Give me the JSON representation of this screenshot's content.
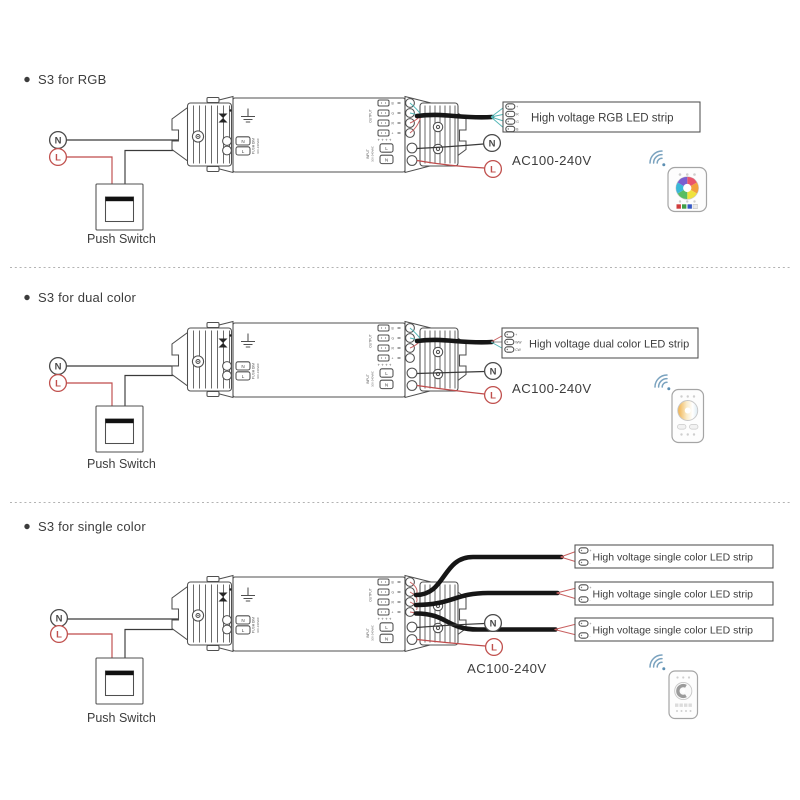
{
  "labels": {
    "n": "N",
    "l": "L"
  },
  "sections": [
    {
      "title": "S3 for RGB",
      "push_switch": "Push Switch",
      "ac": "AC100-240V",
      "strip": {
        "label": "High voltage RGB LED strip",
        "pins": [
          "+",
          "R",
          "G",
          "B"
        ]
      },
      "remote": "rgb-color-wheel-remote"
    },
    {
      "title": "S3 for dual color",
      "push_switch": "Push Switch",
      "ac": "AC100-240V",
      "strip": {
        "label": "High voltage dual color LED strip",
        "pins": [
          "+",
          "WW",
          "CW"
        ]
      },
      "remote": "dual-white-wheel-remote"
    },
    {
      "title": "S3 for single color",
      "push_switch": "Push Switch",
      "ac": "AC100-240V",
      "strips": [
        {
          "label": "High voltage single color LED strip",
          "pins": [
            "+",
            "-"
          ]
        },
        {
          "label": "High voltage single color LED strip",
          "pins": [
            "+",
            "-"
          ]
        },
        {
          "label": "High voltage single color LED strip",
          "pins": [
            "+",
            "-"
          ]
        }
      ],
      "remote": "single-color-dimmer-remote"
    }
  ],
  "controller": {
    "output_label": "OUTPUT",
    "output_pins": [
      "B",
      "G",
      "R",
      "+"
    ],
    "output_plus_row": "+ + + +",
    "push_dim_label": "PUSH DIM",
    "push_dim_pins": [
      "N",
      "L"
    ],
    "input_label": "INPUT",
    "input_voltage": "100-240VAC",
    "input_pins": [
      "L",
      "N"
    ]
  },
  "colors": {
    "outline": "#4f4f4f",
    "live_wire": "#bf4b4b",
    "neutral_wire": "#3a3a3a",
    "signal_wire": "#54b7b7",
    "cable": "#161616",
    "text": "#3d3d3d",
    "wifi": "#7ba3bf"
  }
}
